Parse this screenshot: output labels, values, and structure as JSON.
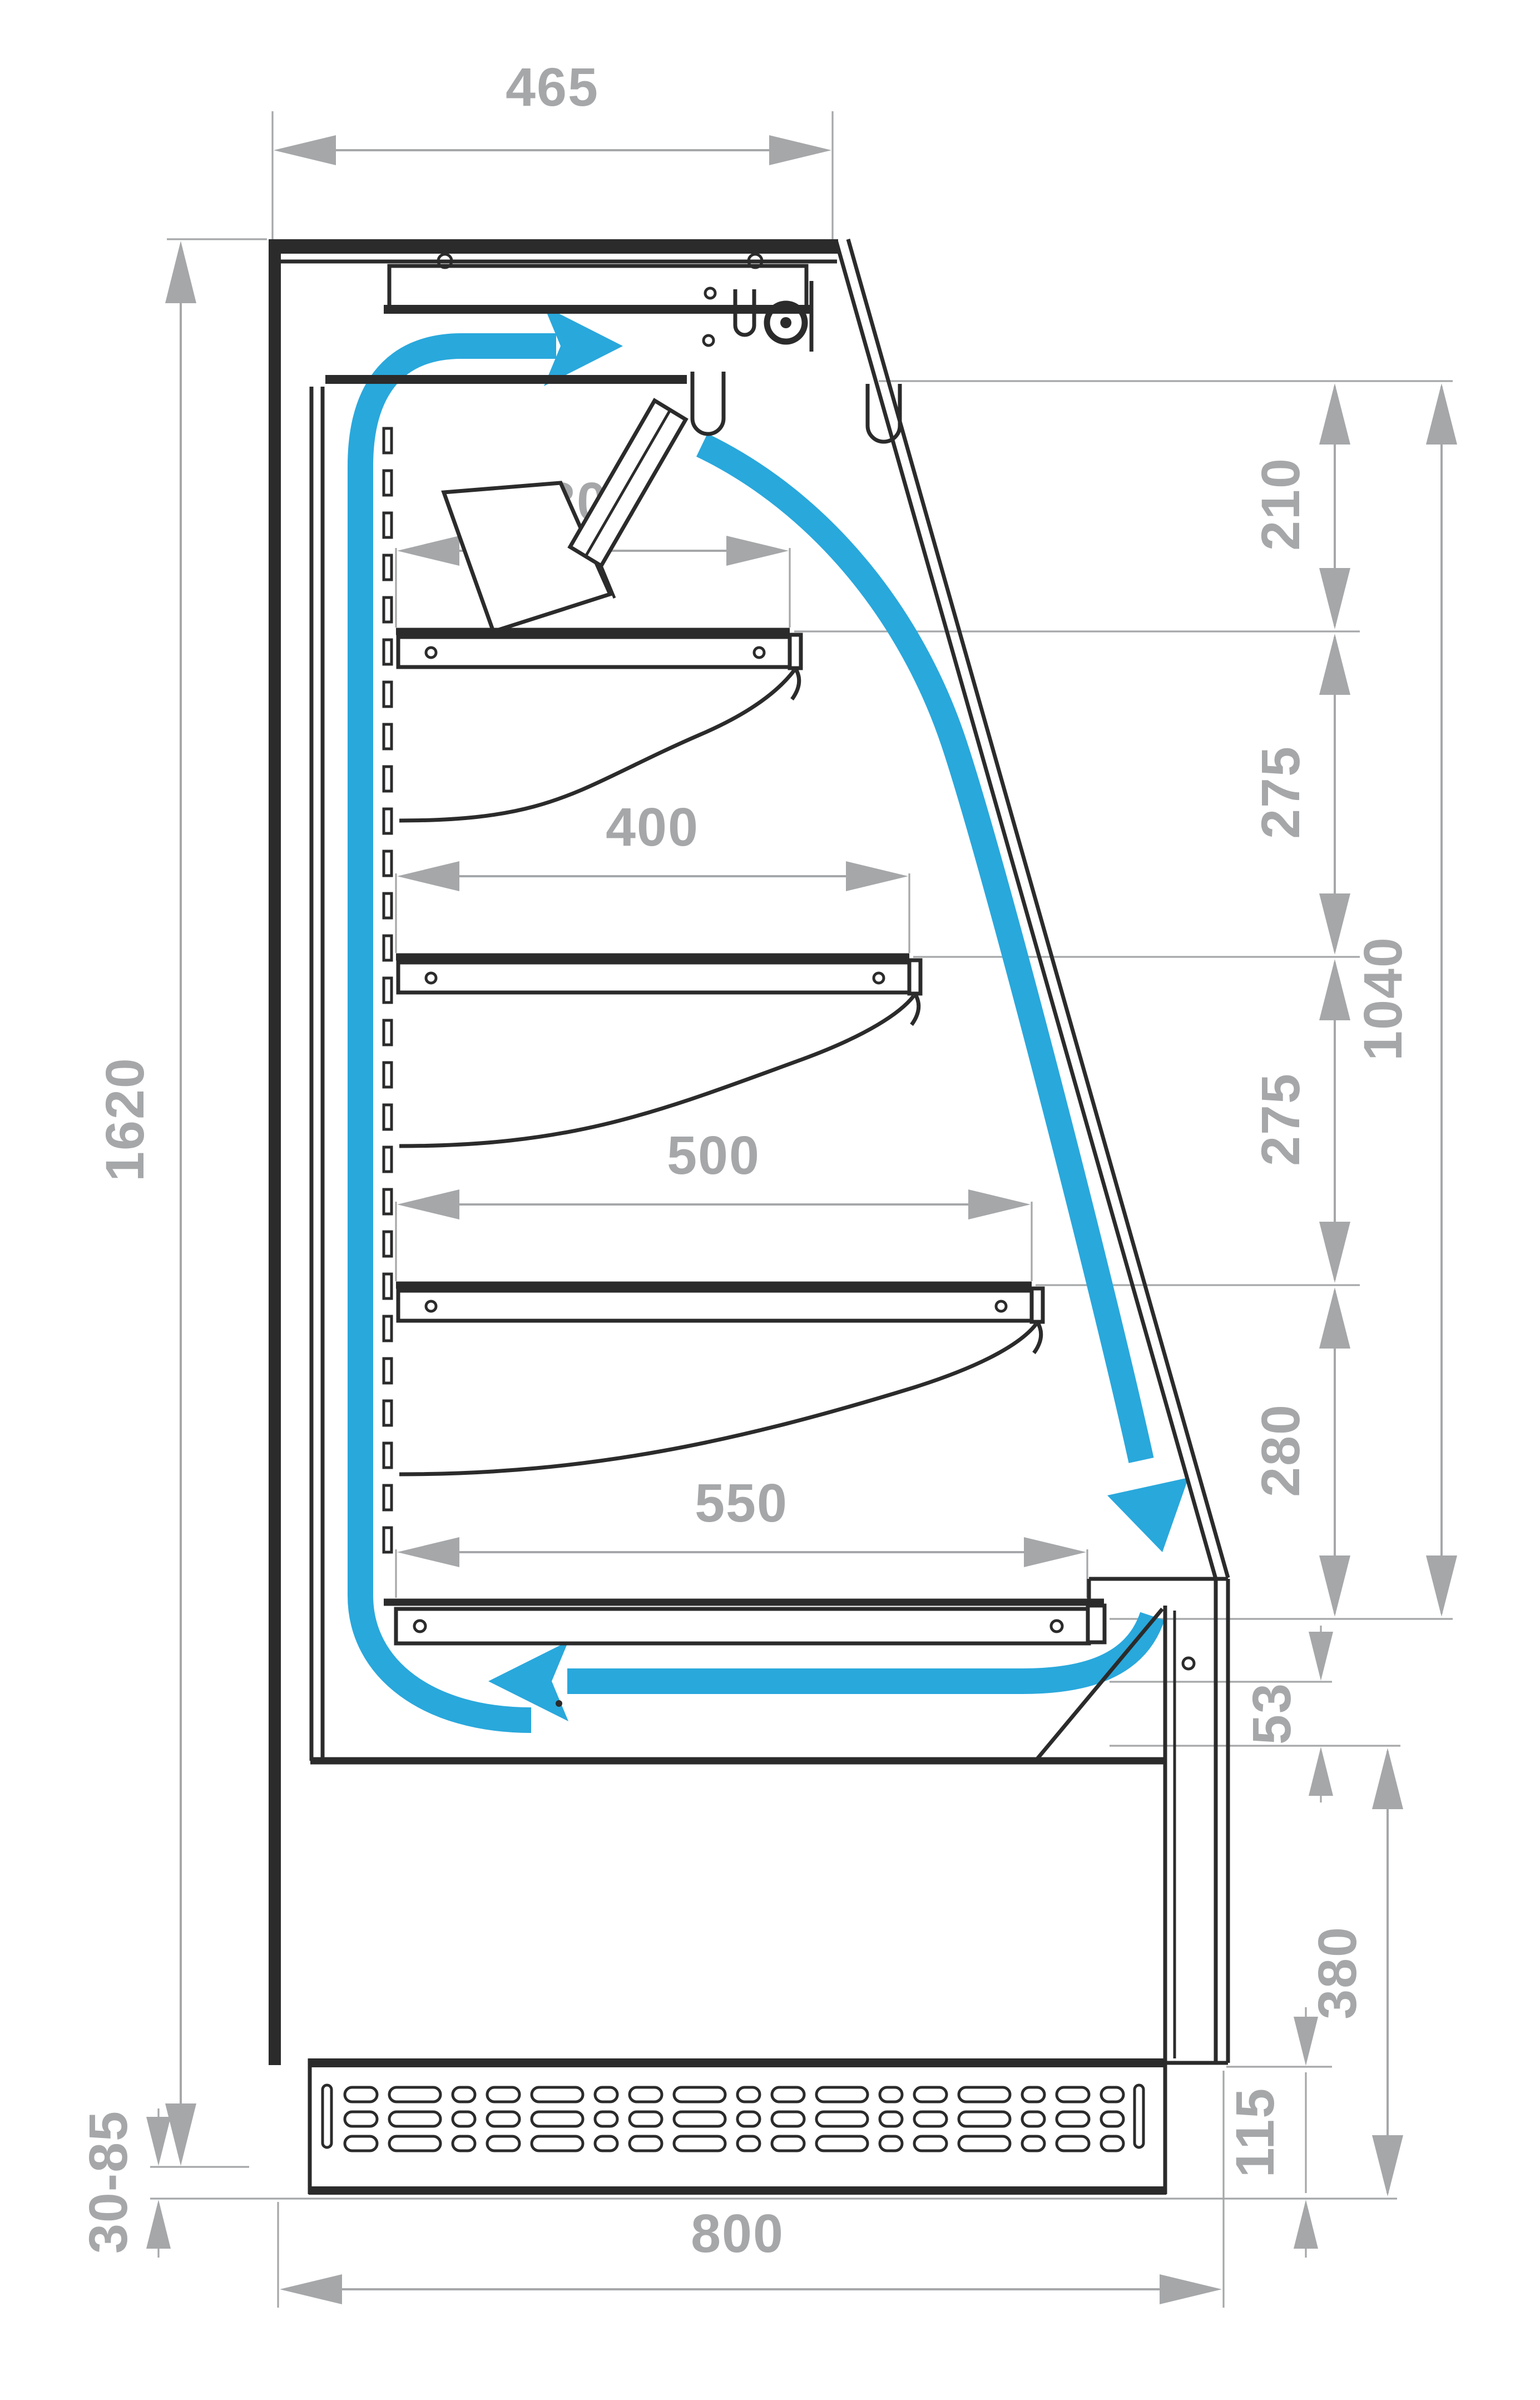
{
  "colors": {
    "linework": "#2b2b2b",
    "dimension_gray": "#a5a7a9",
    "airflow_blue": "#29a8dc",
    "background": "#ffffff"
  },
  "labels": {
    "top_width": "465",
    "total_height": "1620",
    "feet_range": "30-85",
    "base_depth": "800",
    "discharge_gap": "210",
    "shelf_gap_1": "275",
    "shelf_gap_2": "275",
    "bottom_gap": "280",
    "opening_height": "1040",
    "shelf_depth_1": "300",
    "shelf_depth_2": "400",
    "shelf_depth_3": "500",
    "deck_depth": "550",
    "sill_height": "53",
    "front_panel_height": "380",
    "plinth_height": "115"
  }
}
